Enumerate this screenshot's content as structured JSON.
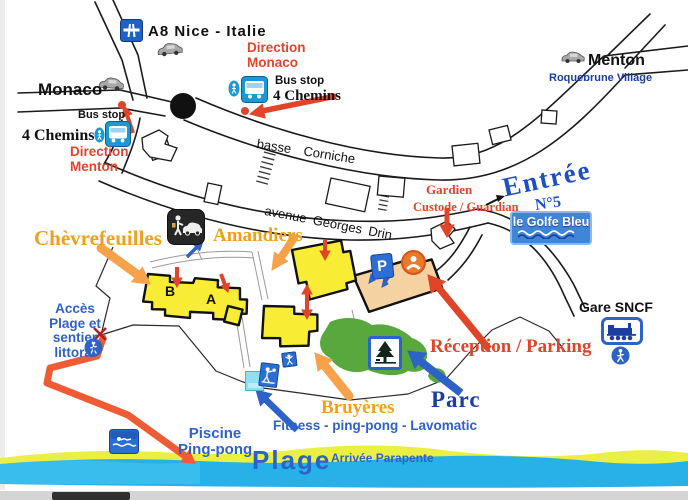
{
  "top": {
    "a8": "A8 Nice - Italie",
    "direction_monaco": [
      "Direction",
      "Monaco"
    ],
    "bus_stop_top": "Bus stop",
    "chemins_top": "4 Chemins",
    "monaco": "Monaco",
    "bus_stop_left": "Bus stop",
    "chemins_left": "4 Chemins",
    "direction_menton": [
      "Direction",
      "Menton"
    ],
    "menton": "Menton",
    "roquebrune": "Roquebrune Village"
  },
  "roads": {
    "basse": "basse Corniche",
    "avenue": "avenue Georges Drin"
  },
  "entrance": {
    "gardien": "Gardien",
    "custode": "Custode / Guardian",
    "entree": "Entrée",
    "n5": "N°5",
    "sign": "le Golfe Bleu"
  },
  "site": {
    "chevrefeuilles": "Chèvrefeuilles",
    "amandiers": "Amandiers",
    "bruyeres": "Bruyères",
    "building_b": "B",
    "building_a": "A",
    "parking_letter": "P",
    "reception": "Réception / Parking",
    "parc": "Parc",
    "fitness": "Fitness - ping-pong - Lavomatic",
    "piscine": [
      "Piscine",
      "Ping-pong"
    ]
  },
  "left": {
    "acces": [
      "Accès",
      "Plage et",
      "sentier",
      "littoral"
    ]
  },
  "right": {
    "gare": "Gare SNCF"
  },
  "beach": {
    "plage": "Plage",
    "parapente": "Arrivée Parapente"
  },
  "colors": {
    "red_text": "#e0452a",
    "orange_text": "#f0a01c",
    "blue_text": "#2d62c9",
    "navy_text": "#1b3f9e",
    "building_yellow": "#f8ec35",
    "reception_tan": "#f5d2a2",
    "park_green": "#58a83e",
    "sand_yellow": "#eaf043",
    "sea_blue": "#28b0e8",
    "sign_blue": "#3f86d8",
    "icon_blue": "#2b6fd4"
  },
  "icons": {
    "motorway-icon": "blue square, white bridge glyph",
    "bus-stop-icon": "blue square, white bus",
    "pedestrian-oval-icon": "blue oval, white walker",
    "car-icon": "grey van silhouette",
    "roundabout": "black filled circle",
    "valet-parking-icon": "dark square, person and car",
    "parking-p-icon": "blue square, white P",
    "reception-person-icon": "orange circle, white figure",
    "tree-sign-icon": "white square blue border, pine tree",
    "train-sign-icon": "white square blue border, locomotive",
    "walker-circle-icon": "blue circle, white walker",
    "swimmer-sign-icon": "blue square, white swimmer",
    "pool-icon": "light blue square",
    "pingpong-icon": "blue square, white player",
    "fitness-icon": "blue square, white figure",
    "no-entry-x": "red cross"
  }
}
